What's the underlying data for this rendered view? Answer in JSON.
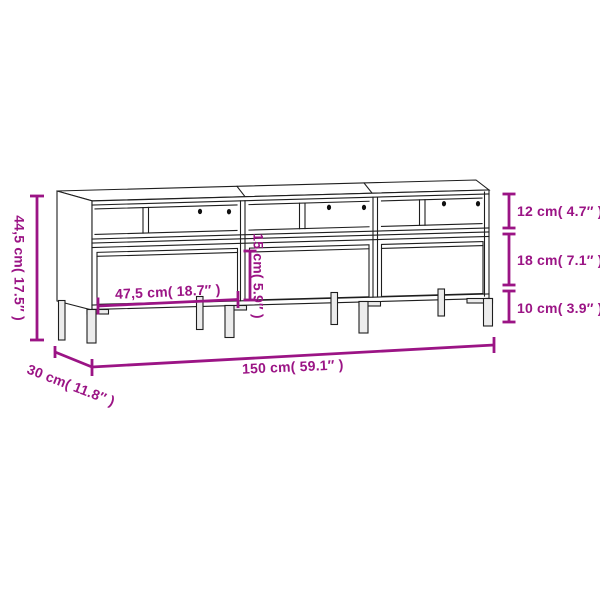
{
  "figure": {
    "type": "furniture-dimension-diagram",
    "product": "TV cabinet with three open compartments and three drawers",
    "background": "#ffffff",
    "outline_color": "#1e1e1e",
    "dimension_color": "#9B1485",
    "dimensions": {
      "overall_height": "44,5 cm( 17.5″ )",
      "compartment_height": "12 cm( 4.7″ )",
      "drawer_section_height": "18 cm( 7.1″ )",
      "leg_height": "10 cm( 3.9″ )",
      "drawer_front_height": "15 cm( 5.9″ )",
      "compartment_width": "47,5 cm( 18.7″ )",
      "overall_width": "150 cm( 59.1″ )",
      "depth": "30 cm( 11.8″ )"
    }
  }
}
